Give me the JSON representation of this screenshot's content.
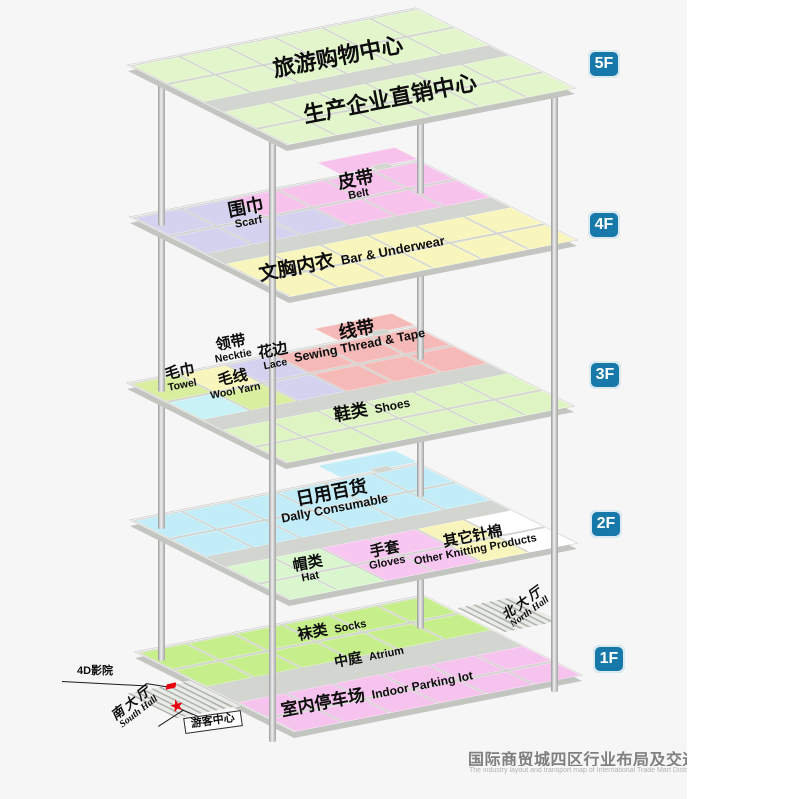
{
  "palette": {
    "base": "#d3d5d0",
    "slab_side": "#c3c5c1",
    "accent_badge": "#1679a9",
    "marker_red": "#e8040c",
    "g5": "#e2f5cb",
    "lav": "#d4d2ef",
    "pnk": "#f7c3ec",
    "yel": "#f8f5bd",
    "cyn": "#c9f2f7",
    "wgr": "#d9ee9e",
    "red": "#f5b9b8",
    "shg": "#def4c2",
    "dcy": "#c2edf8",
    "hgr": "#d9f6cf",
    "gpk": "#f7c7f1",
    "wht": "#ffffff",
    "sog": "#c6ee8a",
    "ppk": "#f6c3ee"
  },
  "title": {
    "zh": "国际商贸城四区行业布局及交通图",
    "en": "The industry layout and transport map of International Trade Mart District Four"
  },
  "floors": [
    {
      "id": "1F",
      "badge": {
        "label": "1F",
        "x": 593,
        "y": 645
      },
      "anchor": {
        "x": 135,
        "y": 652
      },
      "rows": [
        {
          "y": 2,
          "h": 44,
          "colors": [
            "sog",
            "sog",
            "sog",
            "sog",
            "sog",
            "sog"
          ]
        },
        {
          "y": 50,
          "h": 44,
          "colors": [
            "sog",
            "sog",
            "sog",
            "sog",
            "sog",
            "sog"
          ]
        },
        {
          "y": 138,
          "h": 40,
          "colors": [
            "ppk",
            "ppk",
            "ppk",
            "ppk",
            "ppk",
            "ppk"
          ]
        },
        {
          "y": 182,
          "h": 36,
          "colors": [
            "ppk",
            "ppk",
            "ppk",
            "ppk",
            "ppk",
            "ppk"
          ]
        }
      ],
      "extras": [
        {
          "x": 446,
          "y": 36,
          "w": 86,
          "h": 68,
          "c": "hatch",
          "name": "north-hall-ramp"
        },
        {
          "x": -102,
          "y": 76,
          "w": 98,
          "h": 70,
          "c": "hatch",
          "name": "south-hall-ramp"
        }
      ]
    },
    {
      "id": "2F",
      "badge": {
        "label": "2F",
        "x": 590,
        "y": 510
      },
      "anchor": {
        "x": 130,
        "y": 520
      },
      "rows": [
        {
          "y": 2,
          "h": 47,
          "colors": [
            "dcy",
            "dcy",
            "dcy",
            "dcy",
            "dcy",
            "dcy"
          ]
        },
        {
          "y": 53,
          "h": 47,
          "colors": [
            "dcy",
            "dcy",
            "dcy",
            "dcy",
            "dcy",
            "dcy"
          ]
        },
        {
          "y": 128,
          "h": 44,
          "colors": [
            "hgr",
            "hgr",
            "gpk",
            "gpk",
            "yel",
            "wht"
          ]
        },
        {
          "y": 176,
          "h": 42,
          "colors": [
            "hgr",
            "hgr",
            "gpk",
            "gpk",
            "yel",
            "wht"
          ]
        }
      ],
      "extras": [
        {
          "x": 322,
          "y": -36,
          "w": 118,
          "h": 32,
          "c": "dcy",
          "name": "floor-annex"
        },
        {
          "x": 372,
          "y": -9,
          "w": 26,
          "h": 12,
          "c": "base",
          "name": "annex-neck"
        }
      ]
    },
    {
      "id": "3F",
      "badge": {
        "label": "3F",
        "x": 589,
        "y": 361
      },
      "anchor": {
        "x": 127,
        "y": 383
      },
      "rows": [
        {
          "y": 2,
          "h": 47,
          "colors": [
            "wgr",
            "yel",
            "lav",
            "red",
            "red",
            "red"
          ]
        },
        {
          "y": 53,
          "h": 47,
          "colors": [
            "cyn",
            "wgr",
            "lav",
            "red",
            "red",
            "red"
          ]
        },
        {
          "y": 128,
          "h": 44,
          "colors": [
            "shg",
            "shg",
            "shg",
            "shg",
            "shg",
            "shg"
          ]
        },
        {
          "y": 176,
          "h": 42,
          "colors": [
            "shg",
            "shg",
            "shg",
            "shg",
            "shg",
            "shg"
          ]
        }
      ],
      "extras": [
        {
          "x": 322,
          "y": -36,
          "w": 118,
          "h": 32,
          "c": "red",
          "name": "floor-annex"
        },
        {
          "x": 372,
          "y": -9,
          "w": 26,
          "h": 12,
          "c": "base",
          "name": "annex-neck"
        }
      ]
    },
    {
      "id": "4F",
      "badge": {
        "label": "4F",
        "x": 588,
        "y": 211
      },
      "anchor": {
        "x": 130,
        "y": 217
      },
      "rows": [
        {
          "y": 2,
          "h": 47,
          "colors": [
            "lav",
            "lav",
            "pnk",
            "pnk",
            "pnk",
            "pnk"
          ]
        },
        {
          "y": 53,
          "h": 47,
          "colors": [
            "lav",
            "lav",
            "lav",
            "pnk",
            "pnk",
            "pnk"
          ]
        },
        {
          "y": 128,
          "h": 44,
          "colors": [
            "yel",
            "yel",
            "yel",
            "yel",
            "yel",
            "yel"
          ]
        },
        {
          "y": 176,
          "h": 42,
          "colors": [
            "yel",
            "yel",
            "yel",
            "yel",
            "yel",
            "yel"
          ]
        }
      ],
      "extras": [
        {
          "x": 322,
          "y": -36,
          "w": 118,
          "h": 32,
          "c": "pnk",
          "name": "floor-annex"
        },
        {
          "x": 372,
          "y": -9,
          "w": 26,
          "h": 12,
          "c": "base",
          "name": "annex-neck"
        }
      ]
    },
    {
      "id": "5F",
      "badge": {
        "label": "5F",
        "x": 588,
        "y": 50
      },
      "anchor": {
        "x": 128,
        "y": 65
      },
      "rows": [
        {
          "y": 2,
          "h": 47,
          "colors": [
            "g5",
            "g5",
            "g5",
            "g5",
            "g5",
            "g5"
          ]
        },
        {
          "y": 53,
          "h": 47,
          "colors": [
            "g5",
            "g5",
            "g5",
            "g5",
            "g5",
            "g5"
          ]
        },
        {
          "y": 128,
          "h": 44,
          "colors": [
            "g5",
            "g5",
            "g5",
            "g5",
            "g5",
            "g5"
          ]
        },
        {
          "y": 176,
          "h": 42,
          "colors": [
            "g5",
            "g5",
            "g5",
            "g5",
            "g5",
            "g5"
          ]
        }
      ],
      "extras": []
    }
  ],
  "grid_cols": {
    "xs": [
      2,
      75,
      148,
      221,
      294,
      367
    ],
    "w": 69
  },
  "pillars": [
    {
      "x": 161,
      "bases": [
        659,
        527,
        390,
        224,
        72
      ]
    },
    {
      "x": 272,
      "bases": [
        740,
        608,
        471,
        305,
        153
      ]
    },
    {
      "x": 420,
      "bases": [
        627,
        495,
        358,
        192,
        40
      ]
    },
    {
      "x": 554,
      "bases": [
        690,
        558,
        421,
        255,
        103
      ]
    }
  ],
  "labels": [
    {
      "zh": "旅游购物中心",
      "x": 338,
      "y": 57,
      "zs": 22,
      "rot": -11,
      "mode": "stack"
    },
    {
      "zh": "生产企业直销中心",
      "x": 390,
      "y": 99,
      "zs": 22,
      "rot": -11,
      "mode": "stack"
    },
    {
      "zh": "皮带",
      "en": "Belt",
      "x": 357,
      "y": 186,
      "zs": 18,
      "es": 11,
      "rot": -11,
      "mode": "stack"
    },
    {
      "zh": "围巾",
      "en": "Scarf",
      "x": 247,
      "y": 214,
      "zs": 18,
      "es": 11,
      "rot": -11,
      "mode": "stack"
    },
    {
      "zh": "文胸内衣",
      "en": "Bar & Underwear",
      "x": 352,
      "y": 258,
      "zs": 19,
      "es": 13,
      "rot": -11,
      "mode": "inline"
    },
    {
      "zh": "线带",
      "en": "Sewing Thread & Tape",
      "x": 358,
      "y": 337,
      "zs": 18,
      "es": 12.5,
      "rot": -11,
      "mode": "stack"
    },
    {
      "zh": "领带",
      "en": "Necktie",
      "x": 232,
      "y": 349,
      "zs": 15,
      "es": 10.5,
      "rot": -11,
      "mode": "stack"
    },
    {
      "zh": "花边",
      "en": "Lace",
      "x": 274,
      "y": 357,
      "zs": 15,
      "es": 10.5,
      "rot": -11,
      "mode": "stack"
    },
    {
      "zh": "毛巾",
      "en": "Towel",
      "x": 181,
      "y": 378,
      "zs": 15,
      "es": 10.5,
      "rot": -11,
      "mode": "stack"
    },
    {
      "zh": "毛线",
      "en": "Wool Yarn",
      "x": 234,
      "y": 384,
      "zs": 15,
      "es": 10.5,
      "rot": -11,
      "mode": "stack"
    },
    {
      "zh": "鞋类",
      "en": "Shoes",
      "x": 372,
      "y": 409,
      "zs": 17,
      "es": 12,
      "rot": -11,
      "mode": "inline"
    },
    {
      "zh": "日用百货",
      "en": "Dally Consumable",
      "x": 333,
      "y": 500,
      "zs": 18,
      "es": 12.5,
      "rot": -11,
      "mode": "stack"
    },
    {
      "zh": "帽类",
      "en": "Hat",
      "x": 309,
      "y": 570,
      "zs": 15,
      "es": 11,
      "rot": -11,
      "mode": "stack"
    },
    {
      "zh": "手套",
      "en": "Gloves",
      "x": 386,
      "y": 556,
      "zs": 15,
      "es": 11,
      "rot": -11,
      "mode": "stack"
    },
    {
      "zh": "其它针棉",
      "en": "Other Knitting Products",
      "x": 474,
      "y": 543,
      "zs": 15,
      "es": 11,
      "rot": -11,
      "mode": "stack"
    },
    {
      "zh": "袜类",
      "en": "Socks",
      "x": 332,
      "y": 629,
      "zs": 15,
      "es": 11,
      "rot": -11,
      "mode": "inline"
    },
    {
      "zh": "中庭",
      "en": "Atrium",
      "x": 369,
      "y": 656,
      "zs": 14,
      "es": 11,
      "rot": -11,
      "mode": "inline",
      "cls": "hall-mid"
    },
    {
      "zh": "室内停车场",
      "en": "Indoor Parking lot",
      "x": 377,
      "y": 693,
      "zs": 17,
      "es": 12,
      "rot": -11,
      "mode": "inline"
    },
    {
      "zh": "北大厅",
      "en": "North Hall",
      "x": 526,
      "y": 607,
      "zs": 13,
      "es": 10,
      "rot": -36,
      "mode": "stack",
      "cls": "hall"
    },
    {
      "zh": "南大厅",
      "en": "South Hall",
      "x": 135,
      "y": 707,
      "zs": 13,
      "es": 10,
      "rot": -38,
      "mode": "stack",
      "cls": "hall"
    },
    {
      "zh": "4D影院",
      "x": 95,
      "y": 672,
      "zs": 11,
      "rot": 0,
      "mode": "stack",
      "cls": "note"
    },
    {
      "zh": "游客中心",
      "x": 213,
      "y": 722,
      "zs": 11,
      "rot": -8,
      "mode": "stack",
      "cls": "note bubble"
    }
  ],
  "leader_lines": [
    {
      "x": 62,
      "y": 681,
      "len": 86,
      "rot": 3
    },
    {
      "x": 146,
      "y": 683,
      "len": 27,
      "rot": 9
    },
    {
      "x": 158,
      "y": 726,
      "len": 30,
      "rot": -33
    },
    {
      "x": 181,
      "y": 709,
      "len": 26,
      "rot": 22
    }
  ],
  "markers": [
    {
      "type": "star",
      "name": "visitor-center-marker",
      "x": 177,
      "y": 706,
      "glyph": "★"
    },
    {
      "type": "dot",
      "name": "4d-cinema-marker",
      "x": 171,
      "y": 686
    }
  ]
}
